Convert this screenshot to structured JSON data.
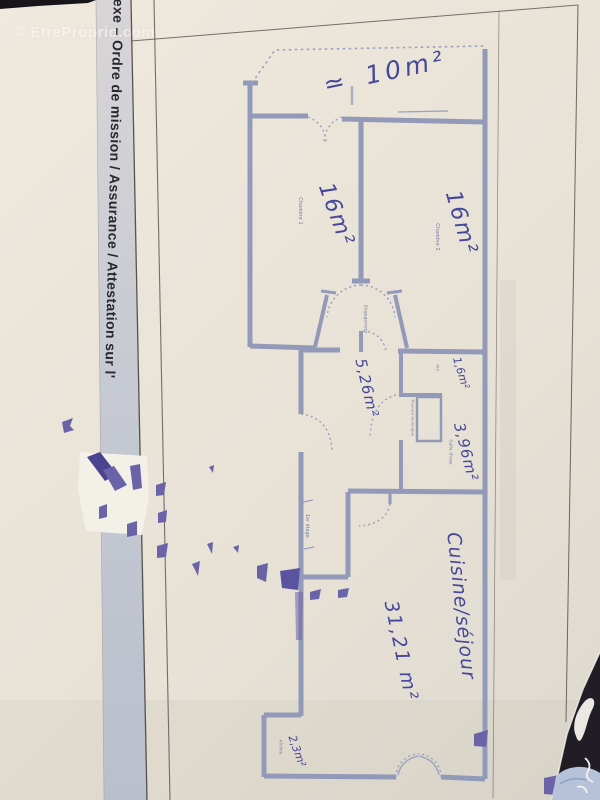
{
  "watermark": "© EtreProprio.com",
  "document_footer": "nexe – Ordre de mission / Assurance / Attestation sur l'",
  "plan": {
    "printed_labels": {
      "chambre1": "Chambre 1",
      "chambre2": "Chambre 2",
      "degagement": "Dégagement",
      "wc": "WC",
      "placard": "Placard technique",
      "salle_deau": "Salle d'eau",
      "etage": "1er étage",
      "alcove": "Alcôve"
    },
    "handwritten": {
      "terrace_area": "≃ 10m²",
      "chambre1_area": "16m²",
      "chambre2_area": "16m²",
      "entree_area": "5,26m²",
      "wc_area": "1,6m²",
      "salle_deau_area": "3,96m²",
      "cuisine_name": "Cuisine/séjour",
      "cuisine_area": "31,21 m²",
      "alcove_area": "2,3m²"
    }
  },
  "colors": {
    "paper": "#e9e3d8",
    "wall_blue": "#8e96b8",
    "ink_blue": "#3d3f97",
    "smudge_purple": "#6b63a8",
    "band_gray": "#c5c9d2",
    "dark_corner": "#201d25"
  }
}
